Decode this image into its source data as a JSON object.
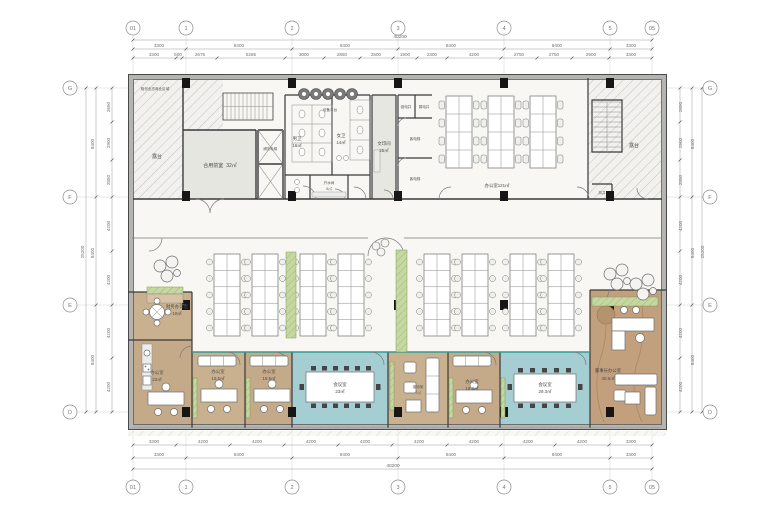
{
  "drawing": {
    "type": "office-floor-plan",
    "grid": {
      "cols": [
        "01",
        "1",
        "2",
        "3",
        "4",
        "5",
        "05"
      ],
      "rows": [
        "G",
        "F",
        "E",
        "D"
      ]
    },
    "dims": {
      "top_outer": "40200",
      "top_main": [
        "3300",
        "8400",
        "8400",
        "8400",
        "8400",
        "3300"
      ],
      "top_sub": [
        "3300",
        "500",
        "2675",
        "5285",
        "3000",
        "2850",
        "2500",
        "1900",
        "2300",
        "4200",
        "2750",
        "2750",
        "2900",
        "3300"
      ],
      "bottom_outer": "40200",
      "bottom_main": [
        "3300",
        "8400",
        "8400",
        "8400",
        "8400",
        "3300"
      ],
      "bottom_sub": [
        "3300",
        "4200",
        "4200",
        "4200",
        "4200",
        "4200",
        "4200",
        "4200",
        "4200",
        "3300"
      ],
      "left_outer": "25200",
      "left_main": [
        "8400",
        "8400",
        "8400"
      ],
      "left_sub": [
        "2650",
        "2900",
        "2850",
        "4200",
        "4200",
        "4200",
        "4200"
      ],
      "right_outer": "25200",
      "right_main": [
        "8400",
        "8400",
        "8400"
      ],
      "right_sub": [
        "2650",
        "2900",
        "2850",
        "4200",
        "4200",
        "4200",
        "4200"
      ]
    },
    "rooms": {
      "terrace_left": "露台",
      "terrace_right": "露台",
      "adjacent_note": "相邻业态商业区域",
      "equipment_platform": "设备平台",
      "shared_lobby": {
        "label": "合用前室",
        "area": "32㎡"
      },
      "mens_wc": {
        "label": "男卫",
        "area": "16㎡"
      },
      "womens_wc": {
        "label": "女卫",
        "area": "14㎡"
      },
      "water_room": {
        "label": "开水间",
        "area": "5㎡"
      },
      "print_room": {
        "label": "文印间",
        "area": "25㎡"
      },
      "strong_shaft": "强电井",
      "weak_shaft": "弱电井",
      "lift1": "客电梯",
      "lift2": "客电梯",
      "fire_lift": "消防电梯",
      "wind_shaft": "风井",
      "office_open_top": {
        "label": "办公室",
        "area": "121㎡"
      },
      "finance_office": {
        "label": "财务办公室",
        "area": "10㎡"
      },
      "office_22": {
        "label": "办公室",
        "area": "22㎡"
      },
      "office_a": {
        "label": "办公室",
        "area": "19.5㎡"
      },
      "office_b": {
        "label": "办公室",
        "area": "19.5㎡"
      },
      "meeting_23": {
        "label": "会议室",
        "area": "23㎡"
      },
      "reception": {
        "label": "接待室",
        "area": "7㎡"
      },
      "office_c": {
        "label": "办公室",
        "area": "18.3㎡"
      },
      "meeting_29": {
        "label": "会议室",
        "area": "29.3㎡"
      },
      "chairman_office": {
        "label": "董事长办公室",
        "area": "40.5㎡"
      }
    }
  }
}
